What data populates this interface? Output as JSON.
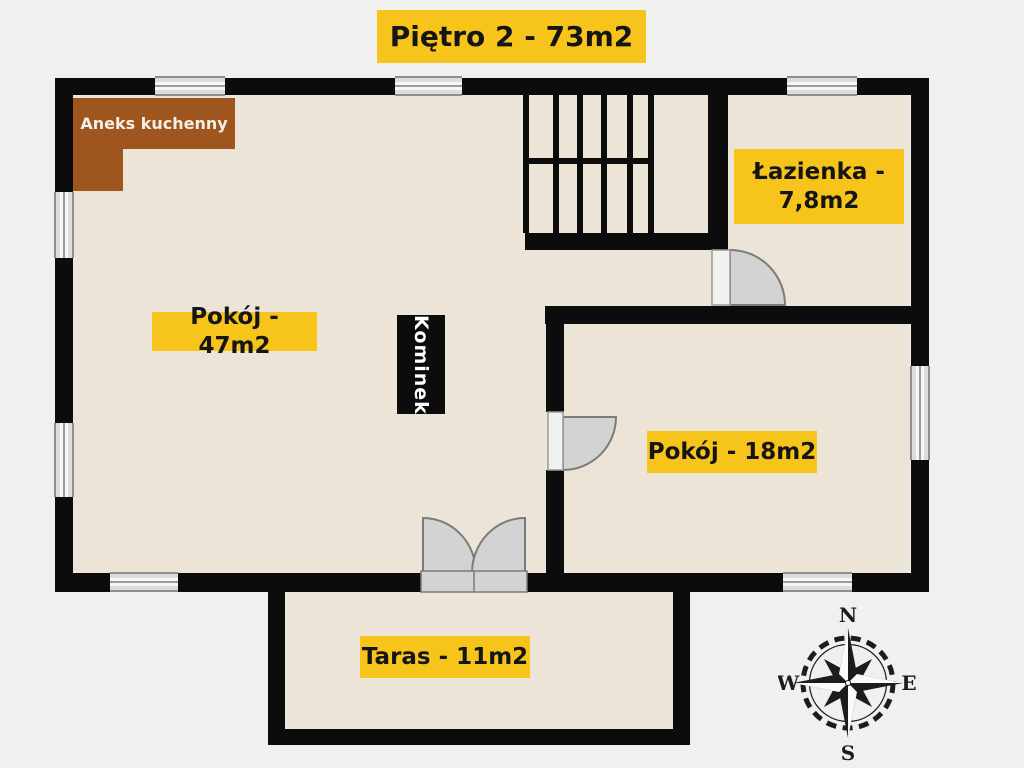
{
  "theme": {
    "colors": {
      "bg": "#f0f0ee",
      "floor": "#ece4d7",
      "wall": "#0c0c0c",
      "accent": "#f6c41a",
      "brown": "#9e551e",
      "label_text": "#151515",
      "white_text": "#f6efe7",
      "door_fill": "#d3d3d3",
      "door_stroke": "#7b7b7b",
      "leaf_fill": "#f1f1ef"
    }
  },
  "title": {
    "text": "Piętro 2 - 73m2"
  },
  "rooms": {
    "main": {
      "label": "Pokój - 47m2"
    },
    "bathroom": {
      "line1": "Łazienka -",
      "line2": "7,8m2"
    },
    "bedroom": {
      "label": "Pokój - 18m2"
    },
    "terrace": {
      "label": "Taras - 11m2"
    },
    "kitchen": {
      "label": "Aneks kuchenny"
    },
    "fireplace": {
      "label": "Kominek"
    }
  },
  "compass": {
    "n": "N",
    "s": "S",
    "e": "E",
    "w": "W"
  }
}
